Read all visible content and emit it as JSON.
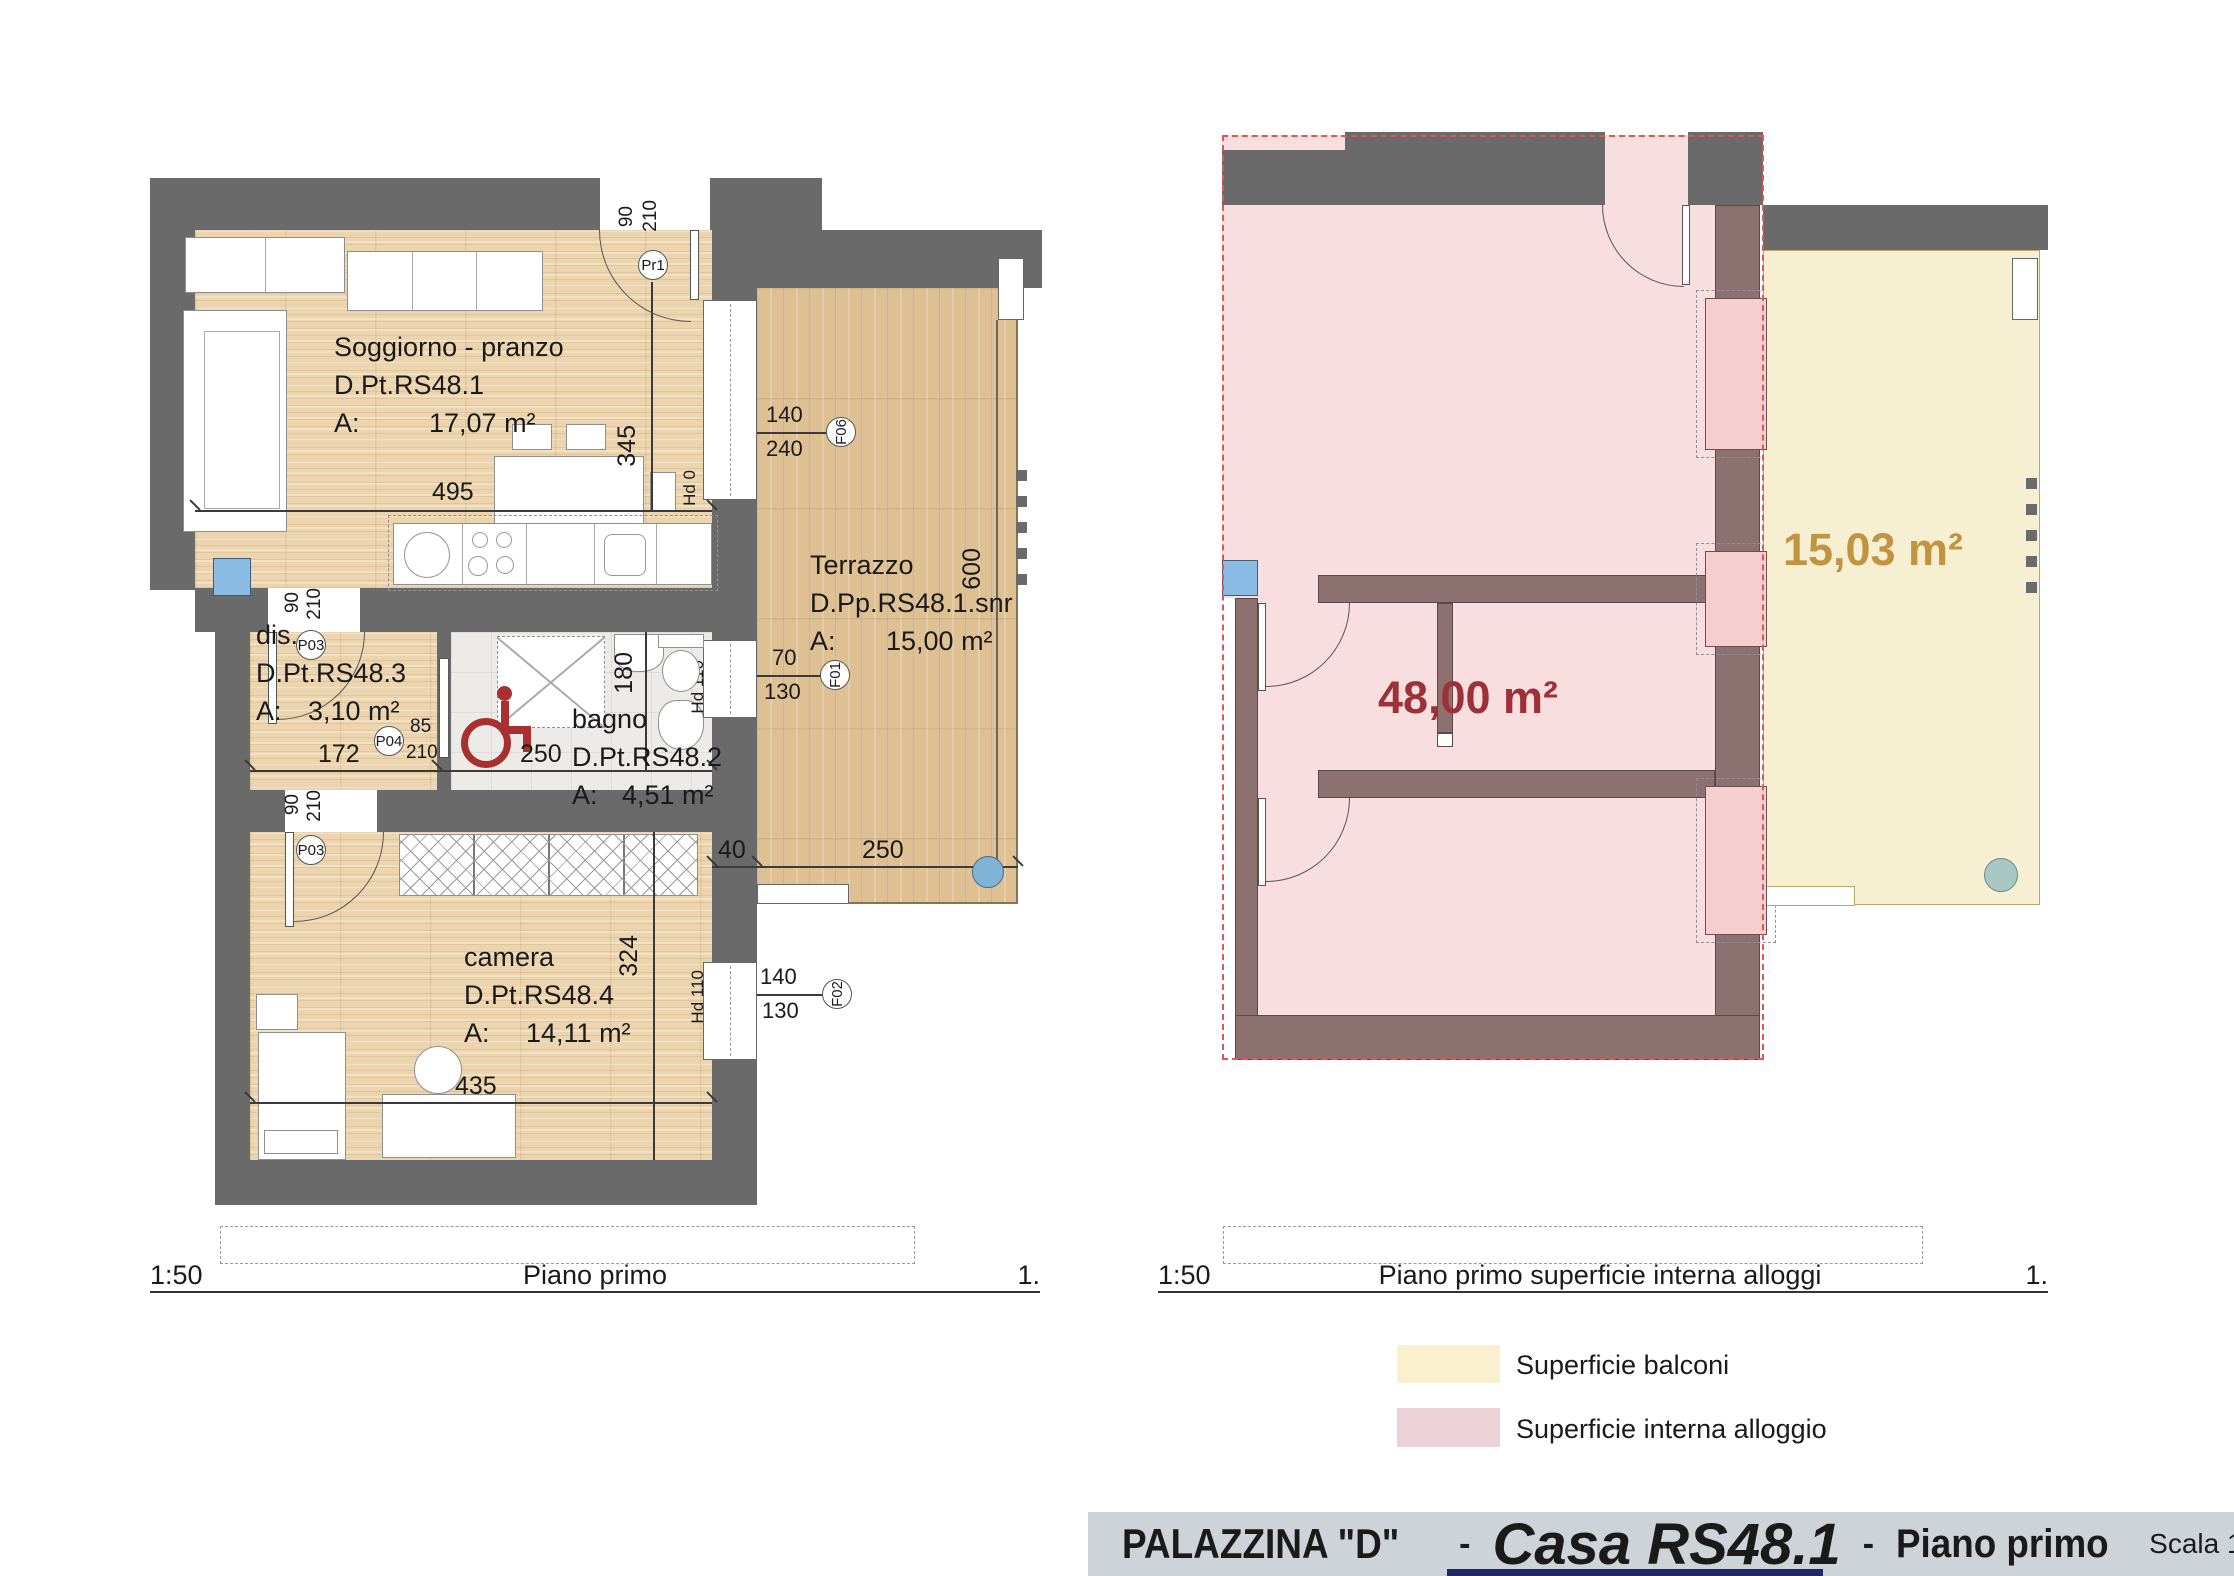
{
  "title_bar": {
    "building": "PALAZZINA  \"D\"",
    "dash": "-",
    "dash2": "-",
    "casa": "Casa RS48.1",
    "floor": "Piano primo",
    "scale": "Scala 1:50"
  },
  "left_plan": {
    "scale_label": "1:50",
    "caption": "Piano primo",
    "sheet": "1.",
    "rooms": [
      {
        "name": "Soggiorno - pranzo",
        "code": "D.Pt.RS48.1",
        "area_label": "A:",
        "area": "17,07 m²"
      },
      {
        "name": "dis.",
        "code": "D.Pt.RS48.3",
        "area_label": "A:",
        "area": "3,10 m²"
      },
      {
        "name": "bagno",
        "code": "D.Pt.RS48.2",
        "area_label": "A:",
        "area": "4,51 m²"
      },
      {
        "name": "camera",
        "code": "D.Pt.RS48.4",
        "area_label": "A:",
        "area": "14,11 m²"
      },
      {
        "name": "Terrazzo",
        "code": "D.Pp.RS48.1.snr",
        "area_label": "A:",
        "area": "15,00 m²"
      }
    ],
    "dimensions": {
      "living_w": "495",
      "living_h": "345",
      "dis_w": "172",
      "bagno_w": "250",
      "bagno_h": "180",
      "camera_h": "324",
      "camera_w": "435",
      "terrace_h": "600",
      "terrace_wall": "40",
      "terrace_w": "250"
    },
    "height_markers": {
      "hd0": "Hd 0",
      "hd110_bagno": "Hd 110",
      "hd110_camera": "Hd 110"
    },
    "doors": [
      {
        "id": "Pr1",
        "w": "90",
        "h": "210"
      },
      {
        "id": "P03",
        "w": "90",
        "h": "210"
      },
      {
        "id": "P04",
        "w": "85",
        "h": "210"
      },
      {
        "id": "P03",
        "w": "90",
        "h": "210"
      }
    ],
    "windows": [
      {
        "id": "F06",
        "w": "140",
        "h": "240"
      },
      {
        "id": "F01",
        "w": "70",
        "h": "130"
      },
      {
        "id": "F02",
        "w": "140",
        "h": "130"
      }
    ]
  },
  "right_plan": {
    "scale_label": "1:50",
    "caption": "Piano primo superficie interna alloggi",
    "sheet": "1.",
    "interior_area": "48,00 m²",
    "balcony_area": "15,03 m²"
  },
  "legend": [
    {
      "label": "Superficie balconi",
      "color": "#faf0ce"
    },
    {
      "label": "Superficie interna alloggio",
      "color": "#ecd2d6"
    }
  ],
  "colors": {
    "wall_gray": "#6a6a6a",
    "wall_mauve": "#8d7070",
    "interior_pink": "#f8dede",
    "balcony_yellow": "#f6efd2",
    "outline_red": "#e05555",
    "area_red": "#9e3038",
    "area_gold": "#c29440",
    "titlebar_bg": "#cdd3d9",
    "marker_blue": "#8abbe4"
  }
}
